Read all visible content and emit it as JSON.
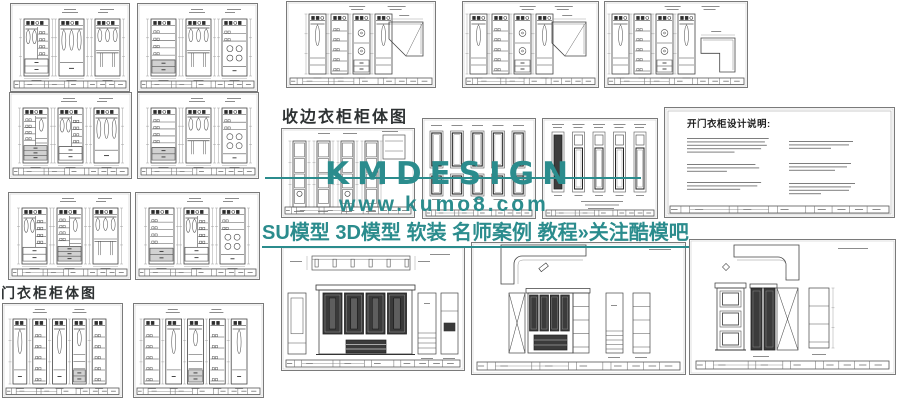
{
  "watermark": {
    "brand": "KMDESIGN",
    "url": "www.kumo8.com",
    "tagline": "SU模型 3D模型 软装 名师案例 教程»关注酷模吧",
    "color": "#2b8c8d"
  },
  "section_titles": {
    "edge_wardrobe": "收边衣柜柜体图",
    "door_wardrobe": "门衣柜柜体图"
  },
  "notes_sheet": {
    "title": "开门衣柜设计说明:"
  },
  "sheets": [
    {
      "id": "wardrobe-elev-a1",
      "kind": "elev3",
      "x": 10,
      "y": 3,
      "w": 120,
      "h": 89,
      "variant": 0
    },
    {
      "id": "wardrobe-elev-a2",
      "kind": "elev3",
      "x": 137,
      "y": 3,
      "w": 121,
      "h": 89,
      "variant": 1
    },
    {
      "id": "wardrobe-elev-b1",
      "kind": "elev3",
      "x": 9,
      "y": 92,
      "w": 123,
      "h": 87,
      "variant": 2
    },
    {
      "id": "wardrobe-elev-b2",
      "kind": "elev3",
      "x": 137,
      "y": 92,
      "w": 122,
      "h": 87,
      "variant": 3
    },
    {
      "id": "wardrobe-elev-c1",
      "kind": "elev3",
      "x": 8,
      "y": 192,
      "w": 123,
      "h": 88,
      "variant": 4
    },
    {
      "id": "wardrobe-elev-c2",
      "kind": "elev3",
      "x": 135,
      "y": 192,
      "w": 125,
      "h": 88,
      "variant": 5
    },
    {
      "id": "door-wardrobe-1",
      "kind": "tall5",
      "x": 2,
      "y": 303,
      "w": 121,
      "h": 95,
      "variant": 0
    },
    {
      "id": "door-wardrobe-2",
      "kind": "tall5",
      "x": 133,
      "y": 303,
      "w": 131,
      "h": 95,
      "variant": 1
    },
    {
      "id": "corner-wardrobe-1",
      "kind": "corner4",
      "x": 286,
      "y": 1,
      "w": 150,
      "h": 87,
      "plan": "pent",
      "variant": 1
    },
    {
      "id": "corner-wardrobe-2",
      "kind": "corner4",
      "x": 462,
      "y": 1,
      "w": 137,
      "h": 87,
      "plan": "pent2",
      "variant": 0
    },
    {
      "id": "corner-wardrobe-3",
      "kind": "corner4",
      "x": 604,
      "y": 1,
      "w": 144,
      "h": 87,
      "plan": "L",
      "variant": 0
    },
    {
      "id": "edge-wardrobe",
      "kind": "edge4",
      "x": 281,
      "y": 128,
      "w": 134,
      "h": 90
    },
    {
      "id": "door-panels-2row",
      "kind": "doors2",
      "x": 422,
      "y": 118,
      "w": 114,
      "h": 101
    },
    {
      "id": "door-panels-1row",
      "kind": "doors1",
      "x": 542,
      "y": 118,
      "w": 116,
      "h": 101
    },
    {
      "id": "design-notes",
      "kind": "notes",
      "x": 664,
      "y": 107,
      "w": 231,
      "h": 111
    },
    {
      "id": "paneled-wardrobe-wide",
      "kind": "panelwide",
      "x": 281,
      "y": 246,
      "w": 184,
      "h": 125
    },
    {
      "id": "paneled-wardrobe-corner-1",
      "kind": "panelcorner",
      "x": 471,
      "y": 242,
      "w": 215,
      "h": 133
    },
    {
      "id": "paneled-wardrobe-corner-2",
      "kind": "panelcorner2",
      "x": 689,
      "y": 239,
      "w": 207,
      "h": 136
    }
  ]
}
